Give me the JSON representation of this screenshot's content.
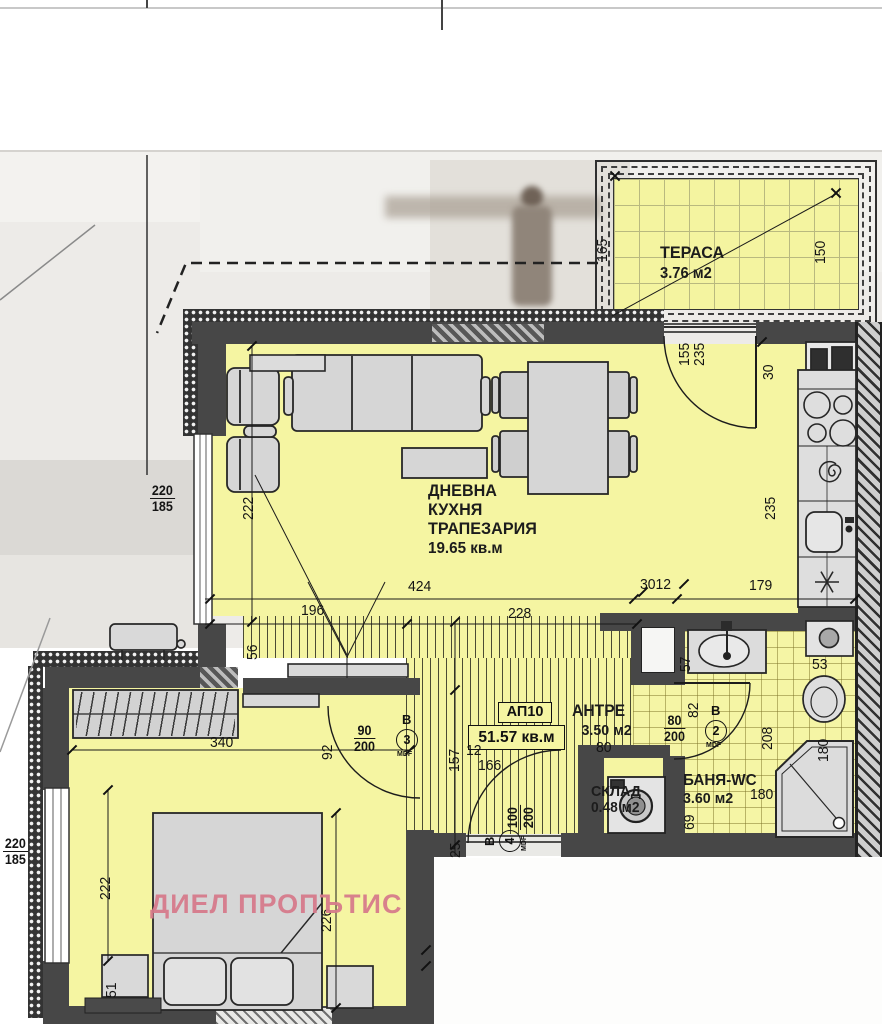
{
  "watermark": "ДИЕЛ ПРОПЪТИС",
  "rooms": {
    "terrace": {
      "name": "ТЕРАСА",
      "area": "3.76 м2"
    },
    "living": {
      "name_line1": "ДНЕВНА",
      "name_line2": "КУХНЯ",
      "name_line3": "ТРАПЕЗАРИЯ",
      "area": "19.65 кв.м"
    },
    "antre": {
      "name": "АНТРЕ",
      "area": "3.50 м2"
    },
    "bathroom": {
      "name": "БАНЯ-WC",
      "area": "3.60 м2"
    },
    "storage": {
      "name": "СКЛАД",
      "area": "0.48 м2"
    },
    "apartment": {
      "number": "АП10",
      "total_area": "51.57 кв.м"
    }
  },
  "doors": [
    {
      "letter": "В",
      "number": "3",
      "material": "MDF",
      "x": 407,
      "y": 740,
      "rot": false
    },
    {
      "letter": "В",
      "number": "2",
      "material": "MDF",
      "x": 716,
      "y": 731,
      "rot": false
    },
    {
      "letter": "В",
      "number": "4",
      "material": "MDF",
      "x": 510,
      "y": 841,
      "rot": true
    }
  ],
  "dimensions": [
    {
      "text": "165",
      "x": 594,
      "y": 262,
      "rot": true
    },
    {
      "text": "150",
      "x": 812,
      "y": 264,
      "rot": true
    },
    {
      "text": "155",
      "x": 676,
      "y": 366,
      "rot": true
    },
    {
      "text": "235",
      "x": 691,
      "y": 366,
      "rot": true
    },
    {
      "text": "30",
      "x": 760,
      "y": 380,
      "rot": true
    },
    {
      "text": "235",
      "x": 762,
      "y": 520,
      "rot": true
    },
    {
      "text": "222",
      "x": 240,
      "y": 520,
      "rot": true
    },
    {
      "text": "424",
      "x": 408,
      "y": 578,
      "rot": false
    },
    {
      "text": "3012",
      "x": 640,
      "y": 576,
      "rot": false
    },
    {
      "text": "179",
      "x": 749,
      "y": 577,
      "rot": false
    },
    {
      "text": "196",
      "x": 301,
      "y": 602,
      "rot": false
    },
    {
      "text": "228",
      "x": 508,
      "y": 605,
      "rot": false
    },
    {
      "text": "56",
      "x": 244,
      "y": 660,
      "rot": true
    },
    {
      "text": "340",
      "x": 210,
      "y": 734,
      "rot": false
    },
    {
      "text": "92",
      "x": 319,
      "y": 760,
      "rot": true
    },
    {
      "text": "157",
      "x": 446,
      "y": 772,
      "rot": true
    },
    {
      "text": "25",
      "x": 447,
      "y": 858,
      "rot": true
    },
    {
      "text": "12",
      "x": 466,
      "y": 742,
      "rot": false
    },
    {
      "text": "166",
      "x": 478,
      "y": 757,
      "rot": false
    },
    {
      "text": "80",
      "x": 596,
      "y": 739,
      "rot": false
    },
    {
      "text": "82",
      "x": 685,
      "y": 718,
      "rot": true
    },
    {
      "text": "57",
      "x": 677,
      "y": 672,
      "rot": true
    },
    {
      "text": "53",
      "x": 812,
      "y": 656,
      "rot": false
    },
    {
      "text": "208",
      "x": 759,
      "y": 750,
      "rot": true
    },
    {
      "text": "180",
      "x": 815,
      "y": 762,
      "rot": true
    },
    {
      "text": "180",
      "x": 750,
      "y": 786,
      "rot": false
    },
    {
      "text": "69",
      "x": 681,
      "y": 830,
      "rot": true
    },
    {
      "text": "222",
      "x": 97,
      "y": 900,
      "rot": true
    },
    {
      "text": "226",
      "x": 318,
      "y": 932,
      "rot": true
    },
    {
      "text": "51",
      "x": 103,
      "y": 998,
      "rot": true
    }
  ],
  "fractions": [
    {
      "top": "220",
      "bottom": "185",
      "x": 150,
      "y": 483,
      "rot": false
    },
    {
      "top": "220",
      "bottom": "185",
      "x": 3,
      "y": 836,
      "rot": false
    },
    {
      "top": "90",
      "bottom": "200",
      "x": 354,
      "y": 723,
      "rot": false
    },
    {
      "top": "80",
      "bottom": "200",
      "x": 664,
      "y": 713,
      "rot": false
    },
    {
      "top": "100",
      "bottom": "200",
      "x": 505,
      "y": 830,
      "rot": true
    }
  ],
  "colors": {
    "room_fill": "#f5f5a2",
    "wall": "#474747",
    "watermark_pink": "#d67a8b",
    "furniture_gray": "#d6d6d6"
  }
}
